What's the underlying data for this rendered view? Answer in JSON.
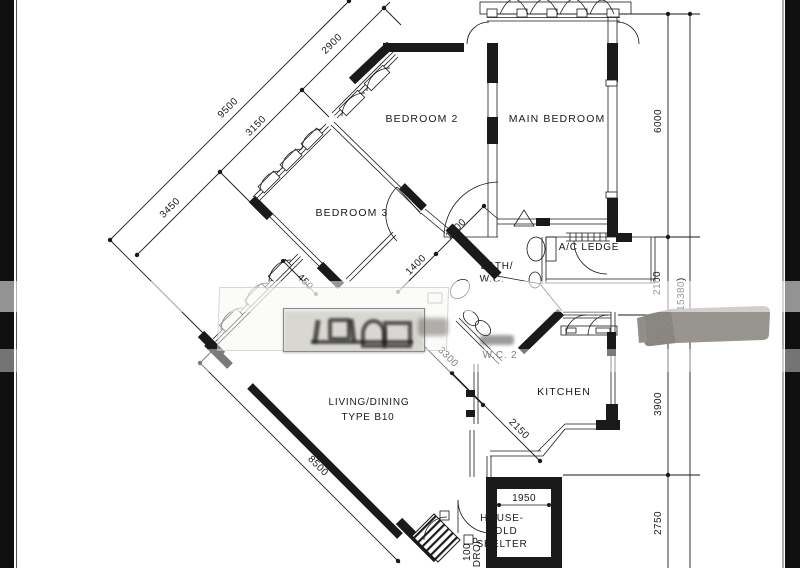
{
  "rooms": {
    "bedroom2": "BEDROOM 2",
    "main_bedroom": "MAIN BEDROOM",
    "bedroom3": "BEDROOM 3",
    "bath1": "BATH/",
    "bath2": "W.C.",
    "ac_ledge": "A/C LEDGE",
    "wc2": "W.C. 2",
    "kitchen": "KITCHEN",
    "living1": "LIVING/DINING",
    "living2": "TYPE B10",
    "shelter1": "HOUSE-",
    "shelter2": "HOLD",
    "shelter3": "SHELTER"
  },
  "dims": {
    "d9500": "9500",
    "d3450": "3450",
    "d3150": "3150",
    "d2900": "2900",
    "d6000": "6000",
    "d2100": "2100",
    "dtotal": "(15380)",
    "d1700": "1700",
    "d1400": "1400",
    "d3300": "3300",
    "d450": "450",
    "d3900": "3900",
    "d2150": "2150",
    "d8500": "8500",
    "d1950": "1950",
    "d2750": "2750",
    "d100": "100",
    "ddrop": "DROP"
  },
  "colors": {
    "ink": "#1a1a1a",
    "paper": "#ffffff",
    "edge_bar": "#101010",
    "redaction": "#918e87"
  }
}
